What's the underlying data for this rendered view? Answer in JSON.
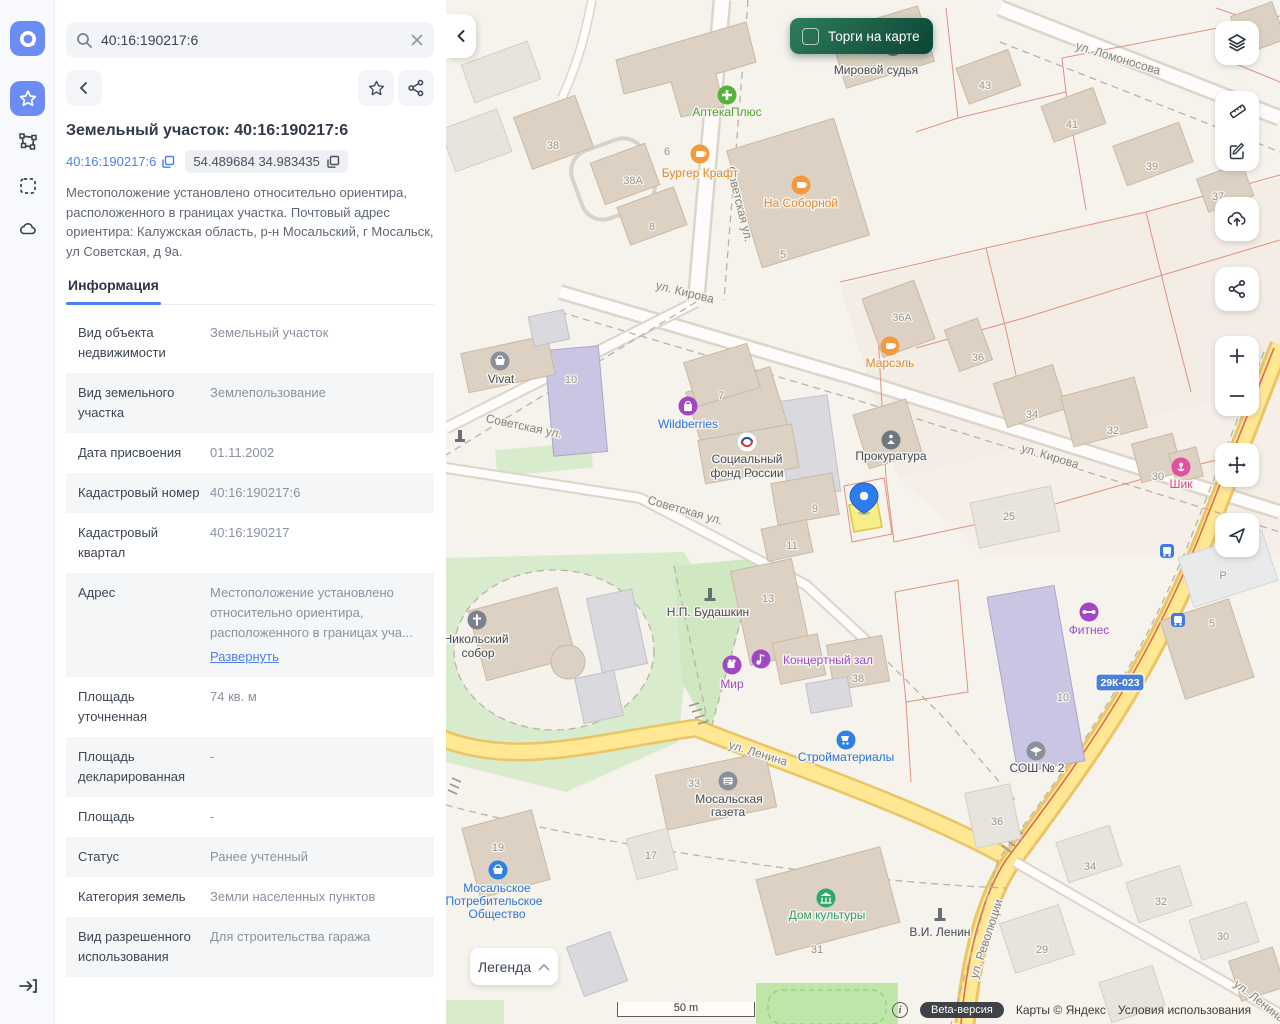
{
  "sidebar": {
    "icons": [
      "app-logo",
      "favorites-star",
      "polygon-tool",
      "select-area",
      "cloud-layers",
      "login"
    ]
  },
  "search": {
    "value": "40:16:190217:6"
  },
  "panel": {
    "title": "Земельный участок: 40:16:190217:6",
    "cadastral_chip": "40:16:190217:6",
    "coords_chip": "54.489684 34.983435",
    "description": "Местоположение установлено относительно ориентира, расположенного в границах участка. Почтовый адрес ориентира: Калужская область, р-н Мосальский, г Мосальск, ул Советская, д 9а.",
    "tab": "Информация",
    "rows": [
      {
        "label": "Вид объекта недвижимости",
        "value": "Земельный участок"
      },
      {
        "label": "Вид земельного участка",
        "value": "Землепользование"
      },
      {
        "label": "Дата присвоения",
        "value": "01.11.2002"
      },
      {
        "label": "Кадастровый номер",
        "value": "40:16:190217:6"
      },
      {
        "label": "Кадастровый квартал",
        "value": "40:16:190217"
      },
      {
        "label": "Адрес",
        "value": "Местоположение установлено относительно ориентира, расположенного в границах уча...",
        "link": "Развернуть"
      },
      {
        "label": "Площадь уточненная",
        "value": "74 кв. м"
      },
      {
        "label": "Площадь декларированная",
        "value": "-"
      },
      {
        "label": "Площадь",
        "value": "-"
      },
      {
        "label": "Статус",
        "value": "Ранее учтенный"
      },
      {
        "label": "Категория земель",
        "value": "Земли населенных пунктов"
      },
      {
        "label": "Вид разрешенного использования",
        "value": "Для строительства гаража"
      }
    ]
  },
  "map": {
    "toggle_label": "Торги на карте",
    "legend_label": "Легенда",
    "scale_label": "50 m",
    "road_badge": "29К-023",
    "attribution": {
      "beta": "Beta-версия",
      "copyright": "Карты © Яндекс",
      "terms": "Условия использования"
    },
    "streets": {
      "lomonosova": "ул. Ломоносова",
      "sovetskaya": "Советская ул.",
      "kirova": "ул. Кирова",
      "lenina": "ул. Ленина",
      "revolyutsii": "ул. Революции"
    },
    "pois": {
      "mirovoy_sudya": "Мировой судья",
      "apteka": "АптекаПлюс",
      "burger_kraft": "Бургер Крафт",
      "na_sobornoy": "На Соборной",
      "marsel": "Марсэль",
      "vivat": "Vivat",
      "wildberries": "Wildberries",
      "sotsfond_1": "Социальный",
      "sotsfond_2": "фонд России",
      "prokuratura": "Прокуратура",
      "shik": "Шик",
      "budashkin": "Н.П. Будашкин",
      "mir": "Мир",
      "kontsertny_zal": "Концертный зал",
      "fitnes": "Фитнес",
      "stroymaterialy": "Стройматериалы",
      "sosh2": "СОШ № 2",
      "gazeta_1": "Мосальская",
      "gazeta_2": "газета",
      "potreb_1": "Мосальское",
      "potreb_2": "Потребительское",
      "potreb_3": "Общество",
      "dom_kultury": "Дом культуры",
      "lenin": "В.И. Ленин",
      "nikolsky_1": "Никольский",
      "nikolsky_2": "собор"
    },
    "houses": {
      "h43": "43",
      "h41": "41",
      "h39": "39",
      "h37": "37",
      "h38": "38",
      "h38a": "38А",
      "h6": "6",
      "h8": "8",
      "h5": "5",
      "h7": "7",
      "h9": "9",
      "h10": "10",
      "h11": "11",
      "h13": "13",
      "h25": "25",
      "h36a": "36А",
      "h36": "36",
      "h34": "34",
      "h32": "32",
      "h30": "30",
      "h33": "33",
      "h17": "17",
      "h19": "19",
      "h29": "29",
      "h31": "31",
      "hP": "P"
    }
  },
  "colors": {
    "accent_blue": "#6b8cf5",
    "link_blue": "#4c7ff0",
    "toggle_green": "#0c4434",
    "parcel_yellow": "#f5ee8a",
    "pin_blue": "#2f7bf0"
  }
}
